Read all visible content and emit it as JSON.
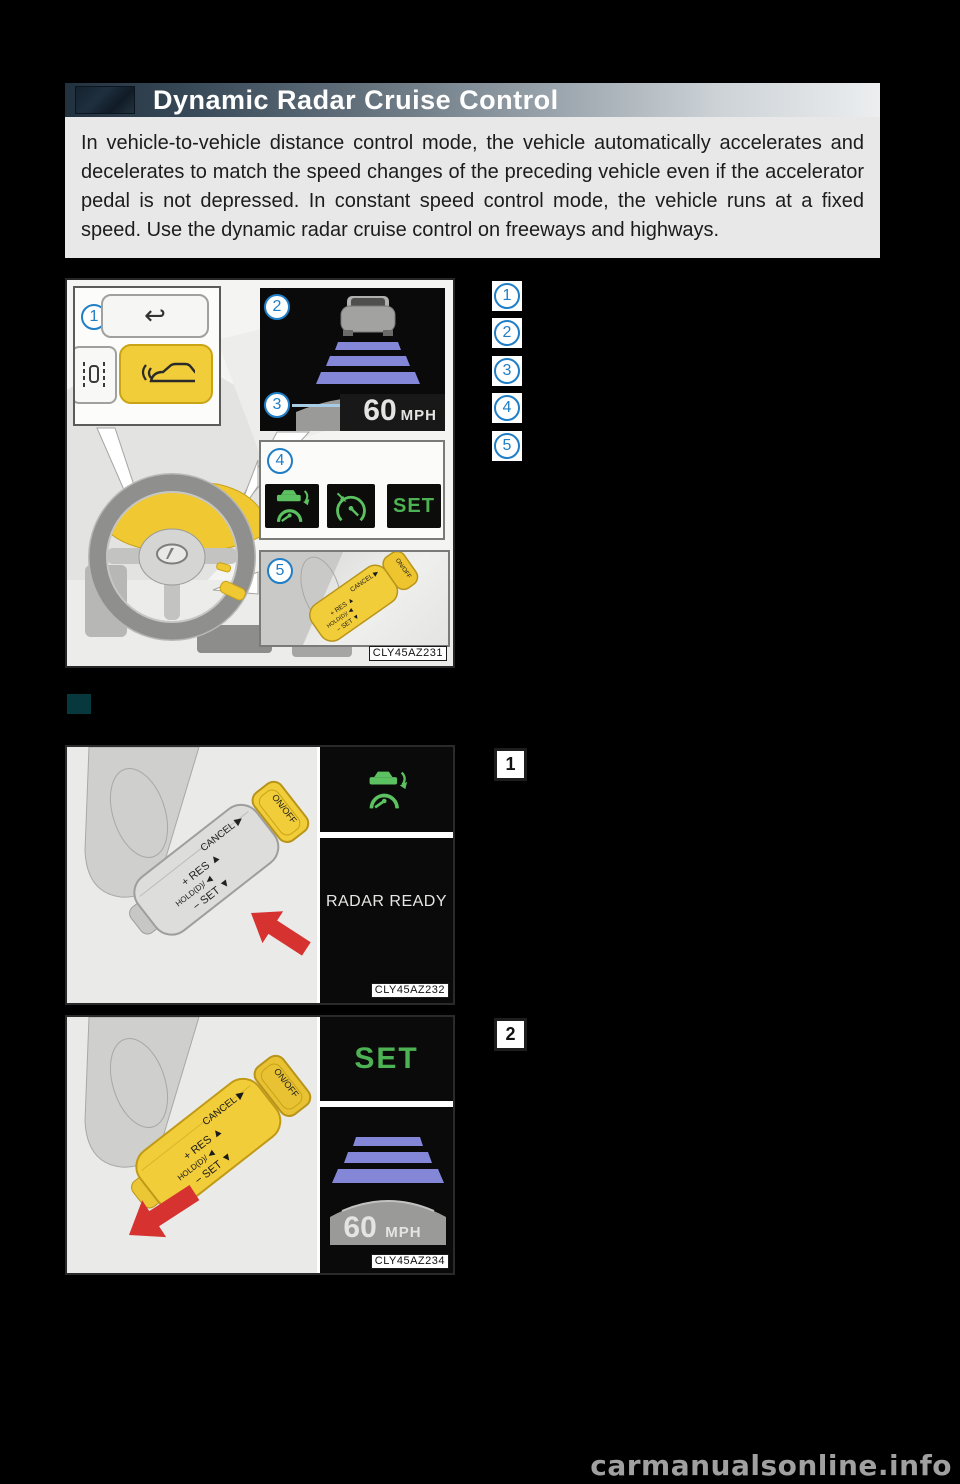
{
  "header": {
    "title": "Dynamic Radar Cruise Control"
  },
  "intro": {
    "text": "In vehicle-to-vehicle distance control mode, the vehicle automatically accelerates and decelerates to match the speed changes of the preceding vehicle even if the accelerator pedal is not depressed. In constant speed control mode, the vehicle runs at a fixed speed. Use the dynamic radar cruise control on freeways and highways."
  },
  "callouts": {
    "items": [
      "1",
      "2",
      "3",
      "4",
      "5"
    ]
  },
  "stalk": {
    "cancel_label": "CANCEL ▶",
    "res_label": "+ RES ▲",
    "hold_label": "HOLD(D)/ ◀",
    "set_label": "− SET ▼",
    "onoff_label": "ON/OFF"
  },
  "figure_main": {
    "tag": "CLY45AZ231",
    "display": {
      "speed": "60",
      "unit": "MPH"
    },
    "indicators": {
      "set_label": "SET",
      "radar_cruise_icon": "radar-cruise-indicator",
      "cruise_icon": "cruise-control-indicator"
    }
  },
  "steps": {
    "one": {
      "number": "1",
      "display_text": "RADAR READY",
      "tag": "CLY45AZ232"
    },
    "two": {
      "number": "2",
      "display_text": "SET",
      "speed": "60",
      "unit": "MPH",
      "tag": "CLY45AZ234"
    }
  },
  "page": {
    "watermark": "carmanualsonline.info"
  },
  "colors": {
    "accent_blue": "#1f7ec6",
    "highlight_yellow": "#f2cd3a",
    "indicator_green": "#4db253",
    "distance_purple": "#8487d8",
    "arrow_red": "#d63230",
    "section_marker_teal": "#07383d"
  }
}
